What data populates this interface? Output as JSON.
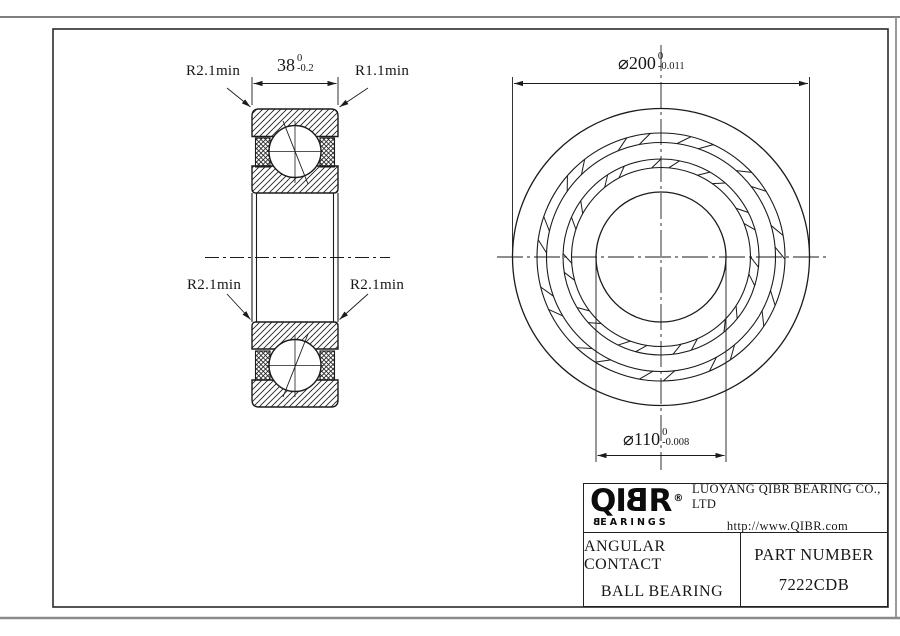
{
  "dims": {
    "width": {
      "value": "38",
      "tol_upper": "0",
      "tol_lower": "-0.2"
    },
    "outer_diameter": {
      "value": "⌀200",
      "tol_upper": "0",
      "tol_lower": "-0.011"
    },
    "bore_diameter": {
      "value": "⌀110",
      "tol_upper": "0",
      "tol_lower": "-0.008"
    },
    "radius_top_left": "R2.1min",
    "radius_top_right": "R1.1min",
    "radius_bottom_left": "R2.1min",
    "radius_bottom_right": "R2.1min"
  },
  "title_block": {
    "logo": {
      "prefix": "QI",
      "mirrored_letter": "B",
      "suffix": "R",
      "registered": "®",
      "sub_first": "B",
      "sub_rest": "EARINGS"
    },
    "company": "LUOYANG QIBR BEARING CO., LTD",
    "website": "http://www.QIBR.com",
    "product_line1": "ANGULAR CONTACT",
    "product_line2": "BALL BEARING",
    "part_number_label": "PART  NUMBER",
    "part_number": "7222CDB"
  },
  "colors": {
    "line": "#1b1b1b",
    "frame": "#2b2b2b",
    "sheet_edge": "#8a8a8a"
  }
}
